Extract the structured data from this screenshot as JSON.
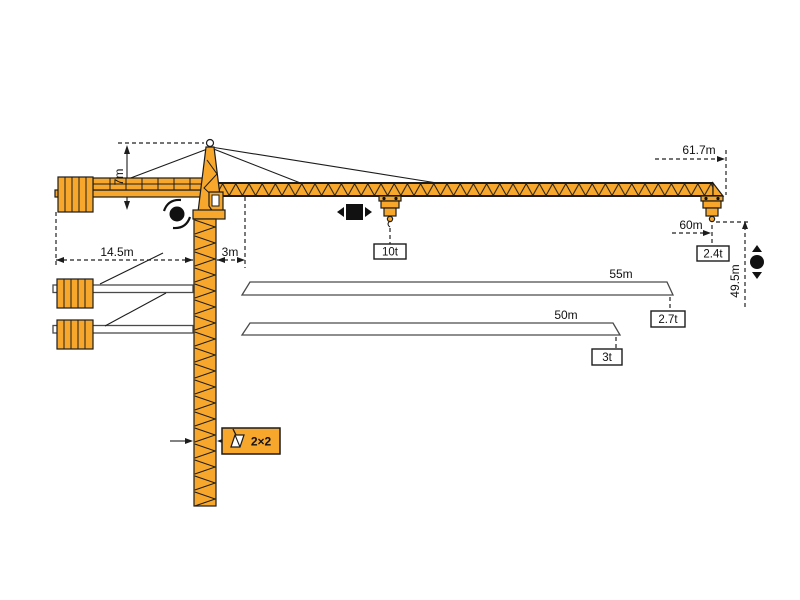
{
  "colors": {
    "crane_orange": "#F6A72C",
    "outline": "#1C1C1C",
    "background": "#FFFFFF"
  },
  "crane": {
    "head_height": "7m",
    "counterjib_radius": "14.5m",
    "jib_root_offset": "3m",
    "mast_section": "2×2"
  },
  "configs": [
    {
      "length": "61.7m",
      "radius": "60m",
      "hook_height": "49.5m",
      "max_capacity": "10t",
      "tip_capacity": "2.4t"
    },
    {
      "length": "55m",
      "tip_capacity": "2.7t"
    },
    {
      "length": "50m",
      "tip_capacity": "3t"
    }
  ],
  "icons": {
    "slewing": "rotation-icon",
    "trolley": "trolley-travel-icon",
    "hoist": "hoist-up-down-icon",
    "section": "mast-cross-section-icon"
  }
}
